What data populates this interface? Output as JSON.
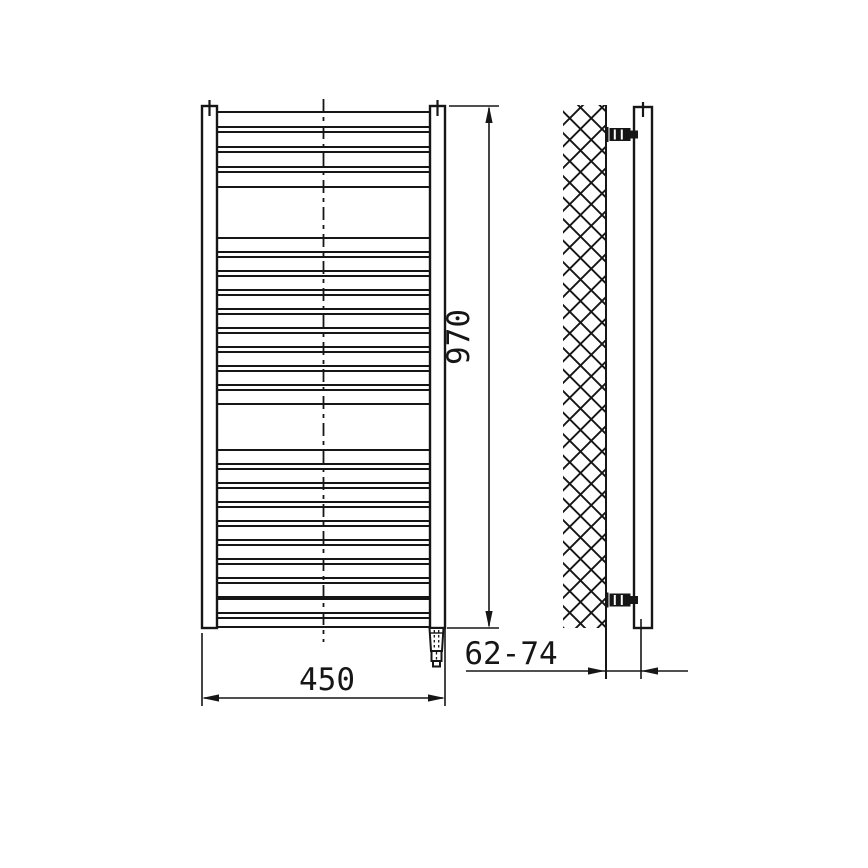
{
  "meta": {
    "drawing_type": "technical-dimension-drawing",
    "subject": "ladder towel radiator, front and side view"
  },
  "labels": {
    "width": "450",
    "height": "970",
    "depth": "62-74"
  },
  "style": {
    "ink": "#161616",
    "bg": "#ffffff",
    "thick": 2.4,
    "medium": 2,
    "thin": 1.6,
    "hatch_stroke": 1.9
  },
  "drawing": {
    "front": {
      "left_rail": {
        "x": 202,
        "y": 106,
        "w": 15,
        "h": 522
      },
      "right_rail": {
        "x": 430,
        "y": 106,
        "w": 15,
        "h": 522
      },
      "rung_x1": 217,
      "rung_x2": 430,
      "tube_groups": [
        {
          "h": 15,
          "tops": [
            112,
            132,
            152,
            172
          ]
        },
        {
          "h": 14,
          "tops": [
            238,
            257,
            276,
            295,
            314,
            333,
            352,
            371,
            390
          ]
        },
        {
          "h": 14,
          "tops": [
            450,
            469,
            488,
            507,
            526,
            545,
            564,
            583,
            599
          ]
        },
        {
          "h": 9,
          "tops": [
            618
          ]
        }
      ],
      "center_line": {
        "x": 323.5,
        "y1": 99,
        "y2": 642,
        "dash": "13 5 4 5"
      },
      "ticks": [
        {
          "x": 209.5,
          "y1": 100,
          "y2": 116
        },
        {
          "x": 437.5,
          "y1": 100,
          "y2": 116
        }
      ],
      "element": {
        "cx": 436.5,
        "top": 628
      }
    },
    "side": {
      "hatch": {
        "x": 563,
        "y": 105,
        "w": 43,
        "h": 523,
        "cell": 21.5
      },
      "wall_face": {
        "x": 606,
        "y1": 105,
        "y2": 679
      },
      "tube": {
        "x": 634,
        "y": 107,
        "w": 18,
        "h": 521
      },
      "tick": {
        "x": 643,
        "y1": 102,
        "y2": 117
      },
      "brackets_cy": [
        134.5,
        600
      ]
    },
    "dims": {
      "height": {
        "x": 489,
        "y1": 106,
        "y2": 628,
        "ext": [
          {
            "x1": 449,
            "y1": 106,
            "x2": 499,
            "y2": 106
          },
          {
            "x1": 447,
            "y1": 628,
            "x2": 499,
            "y2": 628
          }
        ],
        "text": {
          "x": 469,
          "y": 337,
          "rotate": -90
        }
      },
      "width": {
        "y": 698,
        "x1": 202,
        "x2": 445,
        "ext": [
          {
            "x1": 202,
            "y1": 633,
            "x2": 202,
            "y2": 706
          },
          {
            "x1": 445,
            "y1": 629,
            "x2": 445,
            "y2": 706
          }
        ],
        "text": {
          "x": 327,
          "y": 690
        }
      },
      "depth": {
        "y": 671,
        "x1": 466,
        "x2": 688,
        "tip_left": 605,
        "tip_right": 641,
        "ext": [
          {
            "x1": 641,
            "y1": 619,
            "x2": 641,
            "y2": 679
          }
        ],
        "text": {
          "x": 511,
          "y": 664
        }
      }
    }
  }
}
